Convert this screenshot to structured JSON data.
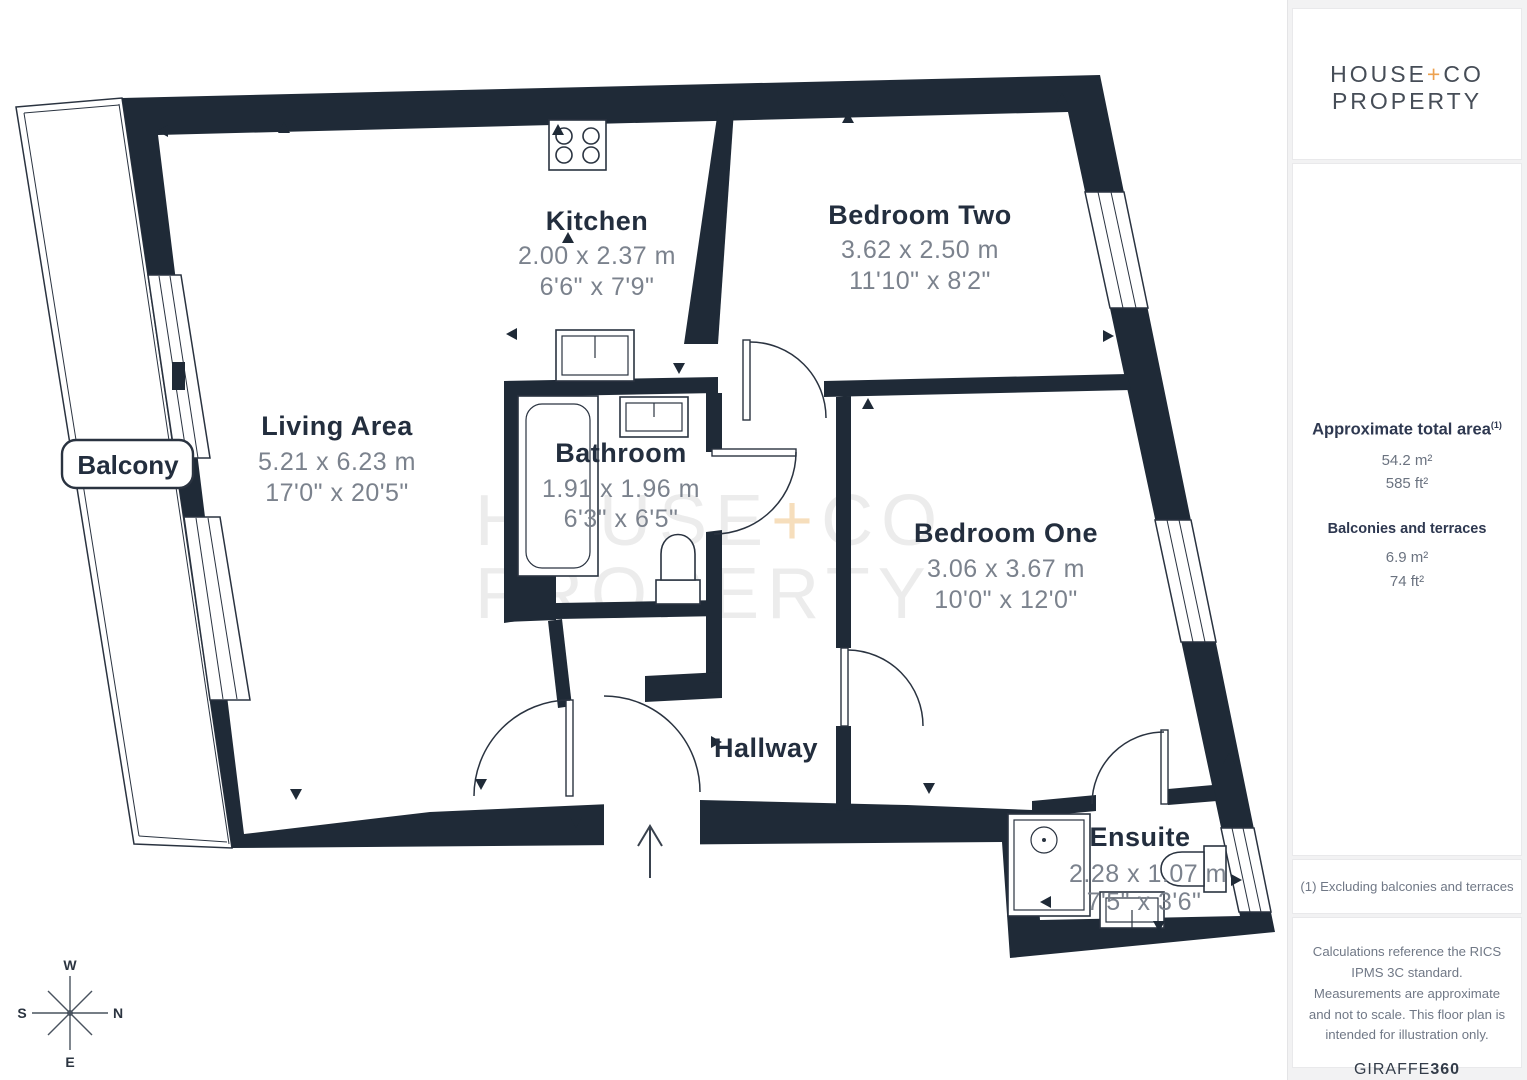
{
  "branding": {
    "logo": {
      "house": "HOUSE",
      "plus": "+",
      "co": "CO",
      "property": "PROPERTY"
    }
  },
  "watermark": {
    "house": "HOUSE",
    "plus": "+",
    "co": "CO",
    "property": "PROPERTY"
  },
  "floorplan": {
    "rooms": [
      {
        "id": "living-area",
        "name": "Living Area",
        "dims_m": "5.21 x 6.23 m",
        "dims_ft": "17'0\" x 20'5\""
      },
      {
        "id": "kitchen",
        "name": "Kitchen",
        "dims_m": "2.00 x 2.37 m",
        "dims_ft": "6'6\" x 7'9\""
      },
      {
        "id": "bedroom-two",
        "name": "Bedroom Two",
        "dims_m": "3.62 x 2.50 m",
        "dims_ft": "11'10\" x 8'2\""
      },
      {
        "id": "bedroom-one",
        "name": "Bedroom One",
        "dims_m": "3.06 x 3.67 m",
        "dims_ft": "10'0\" x 12'0\""
      },
      {
        "id": "bathroom",
        "name": "Bathroom",
        "dims_m": "1.91 x 1.96 m",
        "dims_ft": "6'3\" x 6'5\""
      },
      {
        "id": "ensuite",
        "name": "Ensuite",
        "dims_m": "2.28 x 1.07 m",
        "dims_ft": "7'5\" x 3'6\""
      },
      {
        "id": "hallway",
        "name": "Hallway"
      },
      {
        "id": "balcony",
        "name": "Balcony"
      }
    ],
    "compass": {
      "top": "W",
      "right": "N",
      "bottom": "E",
      "left": "S"
    },
    "colors": {
      "wall": "#1f2a37",
      "accent_orange": "#eda14f",
      "dims_gray": "#7b828d",
      "label_dark": "#232e3e"
    }
  },
  "sidebar": {
    "total_area": {
      "heading": "Approximate total area",
      "footnote_marker": "(1)",
      "sqm": "54.2 m²",
      "sqft": "585 ft²"
    },
    "balconies": {
      "heading": "Balconies and terraces",
      "sqm": "6.9 m²",
      "sqft": "74 ft²"
    },
    "footnote": "(1) Excluding balconies and terraces",
    "disclaimer": "Calculations reference the RICS IPMS 3C standard. Measurements are approximate and not to scale. This floor plan is intended for illustration only.",
    "credit": {
      "brand": "GIRAFFE",
      "suffix": "360"
    }
  }
}
